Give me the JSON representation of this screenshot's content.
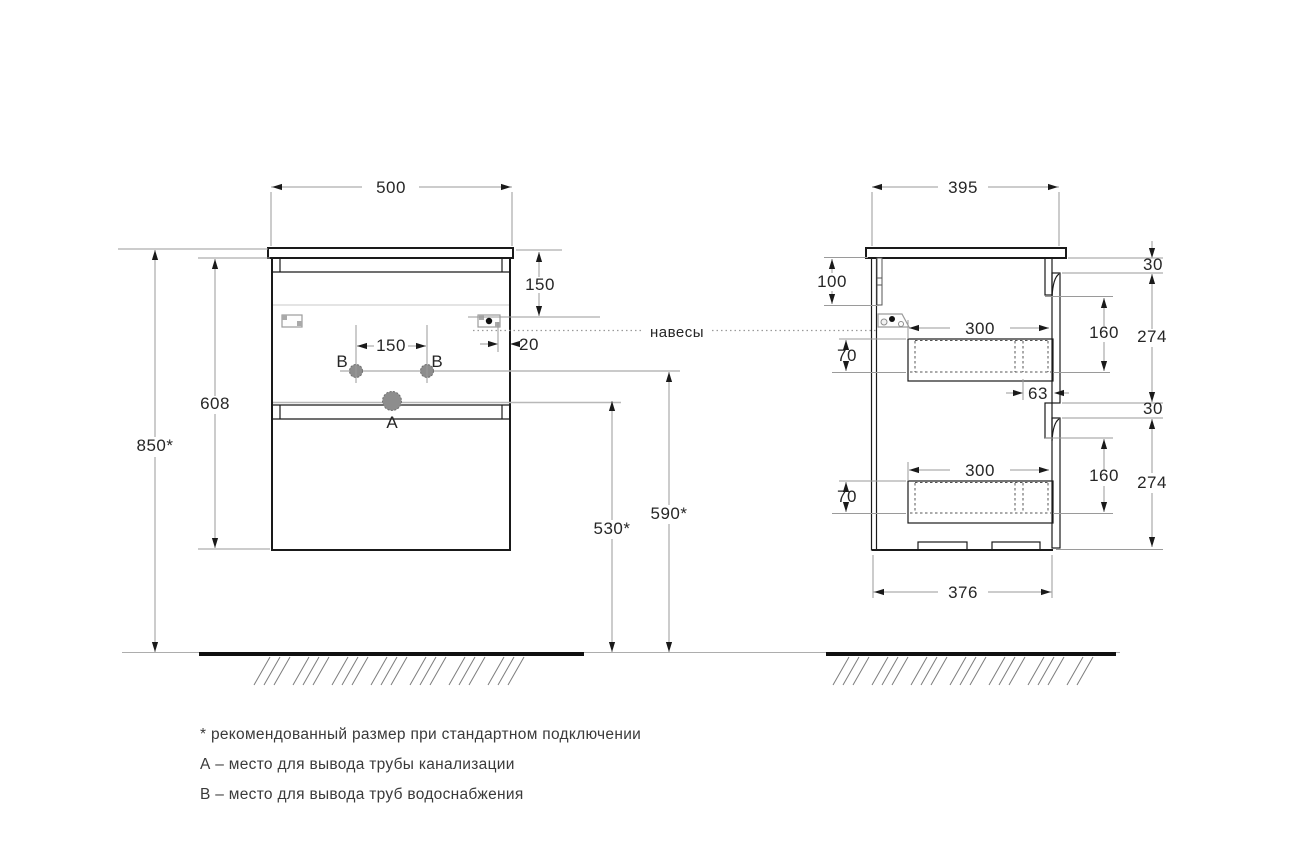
{
  "document": {
    "kind": "furniture installation drawing",
    "background": "#ffffff",
    "line_color": "#1a1a1a",
    "dimension_line_color": "#9a9a9a"
  },
  "front_view": {
    "dim_width": "500",
    "dim_total_height": "850*",
    "dim_cabinet_height": "608",
    "dim_top_to_hanger": "150",
    "dim_hanger_inset": "20",
    "dim_hole_spacing": "150",
    "dim_drain_outlet_height": "530*",
    "dim_water_outlet_height": "590*",
    "label_hole_a": "A",
    "label_hole_b_left": "B",
    "label_hole_b_right": "B"
  },
  "side_view": {
    "dim_depth": "395",
    "dim_back_rail_height": "100",
    "dim_top_drawer_inner_height": "70",
    "dim_top_drawer_inner_depth": "300",
    "dim_front_offset": "63",
    "dim_top_gap": "30",
    "dim_top_front_inner_height": "160",
    "dim_top_front_height": "274",
    "dim_bottom_gap": "30",
    "dim_bottom_front_inner_height": "160",
    "dim_bottom_front_height": "274",
    "dim_bottom_drawer_inner_height": "70",
    "dim_bottom_drawer_inner_depth": "300",
    "dim_body_depth": "376"
  },
  "callouts": {
    "hangers": "навесы"
  },
  "footnotes": {
    "recommended": "* рекомендованный размер при стандартном подключении",
    "a": "А – место для вывода трубы канализации",
    "b": "В – место для вывода труб водоснабжения"
  }
}
